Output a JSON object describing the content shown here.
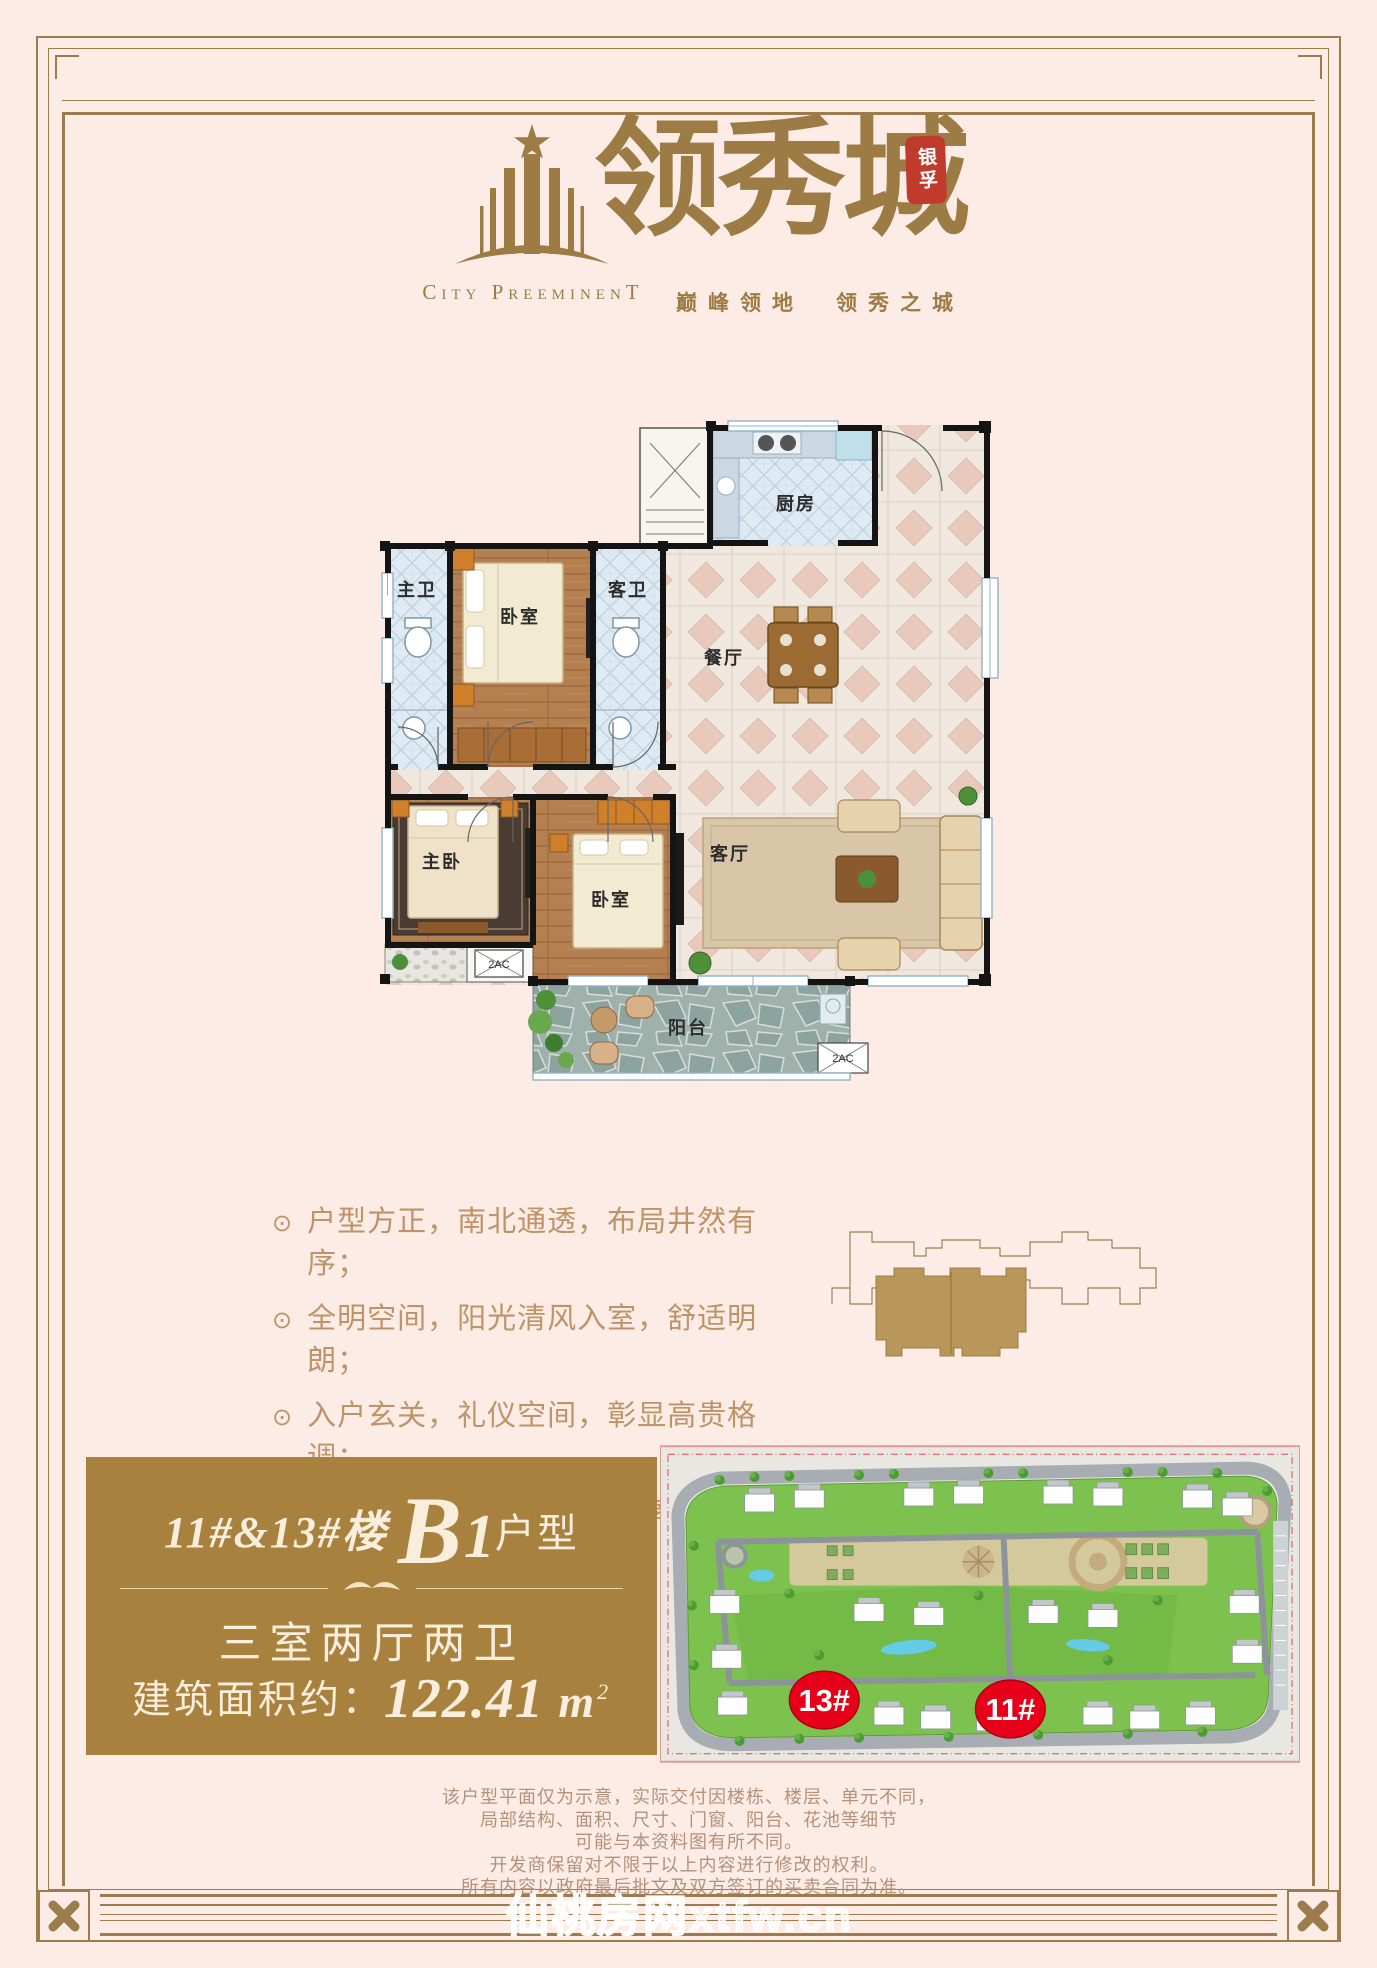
{
  "colors": {
    "page_bg": "#fcece5",
    "frame_brown": "#9c7c4c",
    "logo_brown": "#9c7b45",
    "banner_brown": "#a9813f",
    "banner_cream": "#f8eedb",
    "seal_red": "#c13b2c",
    "marker_red": "#e60019"
  },
  "logo": {
    "en": "City PreeminenT",
    "cn": "领秀城",
    "seal": "银孚",
    "slogan": "巅峰领地　领秀之城"
  },
  "floor_plan": {
    "labels": {
      "master_bath": "主卫",
      "bedroom2": "卧室",
      "guest_bath": "客卫",
      "kitchen": "厨房",
      "dining": "餐厅",
      "living": "客厅",
      "master_bedroom": "主卧",
      "bedroom3": "卧室",
      "balcony": "阳台",
      "ac": "2AC"
    }
  },
  "features": {
    "bullet": "⊙",
    "items": [
      "户型方正，南北通透，布局井然有序；",
      "全明空间，阳光清风入室，舒适明朗；",
      "入户玄关，礼仪空间，彰显高贵格调；",
      "大尺度全景南向阳台，尊享无敌阔景。"
    ]
  },
  "unit_banner": {
    "building": "11#&13#楼",
    "type_letter": "B",
    "type_number": "1",
    "type_suffix": "户型",
    "rooms": "三室两厅两卫",
    "area_prefix": "建筑面积约：",
    "area_value": "122.41",
    "area_unit": "m",
    "area_sup": "2"
  },
  "site_map": {
    "marker_left": "13#",
    "marker_right": "11#"
  },
  "disclaimer": {
    "lines": [
      "该户型平面仅为示意，实际交付因楼栋、楼层、单元不同，",
      "局部结构、面积、尺寸、门窗、阳台、花池等细节",
      "可能与本资料图有所不同。",
      "开发商保留对不限于以上内容进行修改的权利。",
      "所有内容以政府最后批文及双方签订的买卖合同为准。"
    ]
  },
  "watermark": "仙桃房网xtfw.cn"
}
